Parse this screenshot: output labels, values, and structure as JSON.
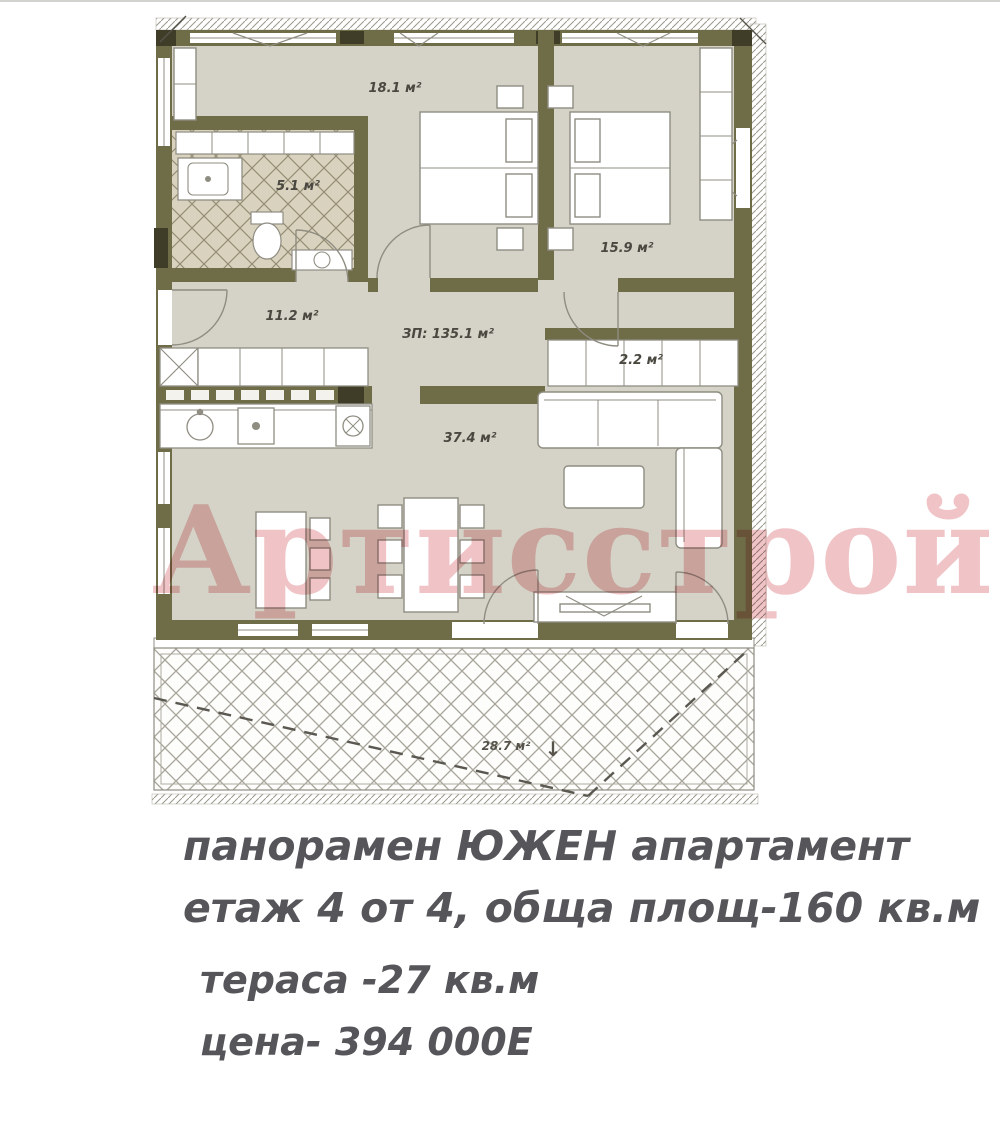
{
  "watermark": {
    "text": "Артисстрой",
    "color": "#e39498"
  },
  "caption": {
    "line1": "панорамен ЮЖЕН апартамент",
    "line2": "етаж 4 от 4, обща площ-160 кв.м",
    "line3": "тераса -27 кв.м",
    "line4": "цена- 394 000Е"
  },
  "plan": {
    "rooms": [
      {
        "name": "bedroom-1",
        "area_label": "18.1 м²"
      },
      {
        "name": "bathroom",
        "area_label": "5.1 м²"
      },
      {
        "name": "bedroom-2",
        "area_label": "15.9 м²"
      },
      {
        "name": "hall",
        "area_label": "11.2 м²"
      },
      {
        "name": "built-area",
        "area_label": "ЗП: 135.1 м²"
      },
      {
        "name": "closet",
        "area_label": "2.2 м²"
      },
      {
        "name": "living-room",
        "area_label": "37.4 м²"
      },
      {
        "name": "terrace",
        "area_label": "28.7 м²"
      }
    ],
    "terrace_arrow": "↓",
    "colors": {
      "wall": "#6f6c48",
      "wall_dark": "#3f3c28",
      "floor": "#d5d3c7",
      "tile_floor": "#d9d2be",
      "outline": "#8f8d82",
      "label_text": "#4a4840",
      "caption_text": "#55555a",
      "watermark_pink": "#e39498"
    }
  }
}
